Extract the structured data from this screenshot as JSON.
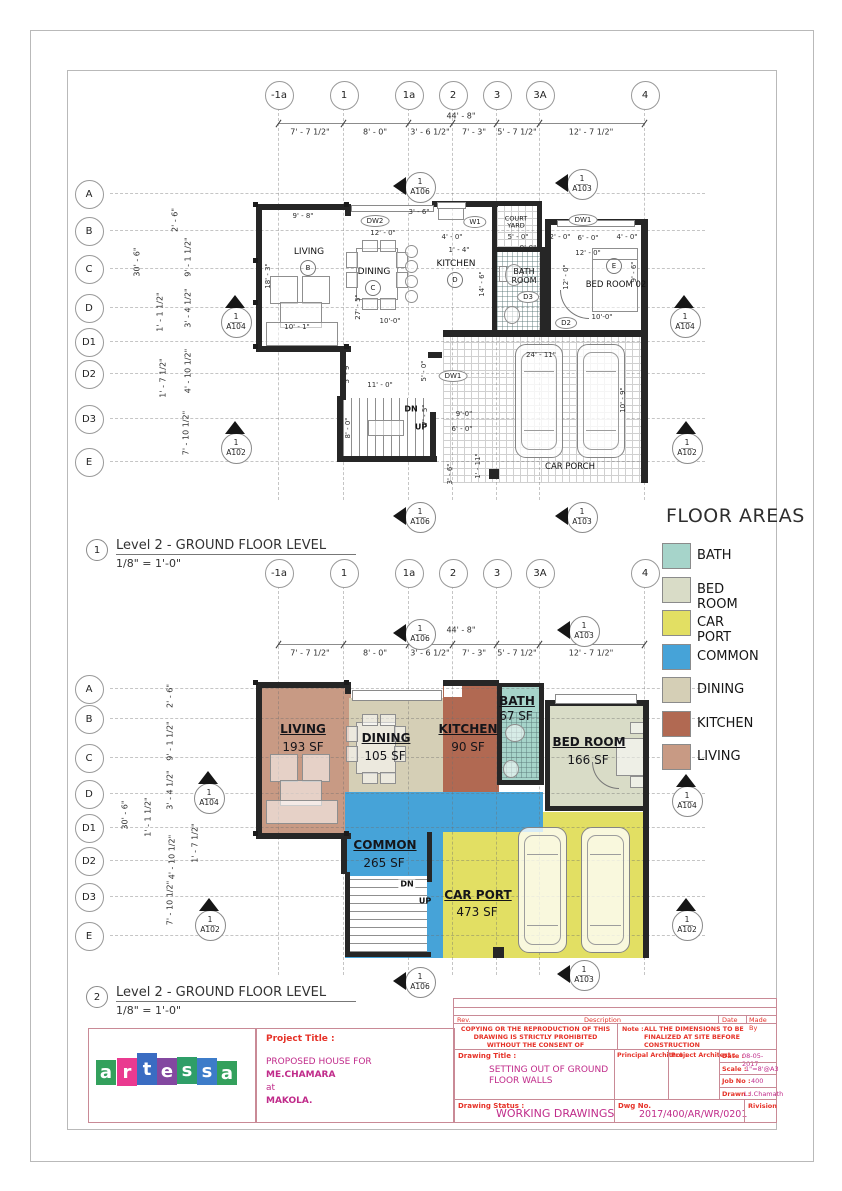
{
  "sheet": {
    "captions": {
      "plan1": {
        "number": "1",
        "title": "Level 2 - GROUND FLOOR LEVEL",
        "scale": "1/8\" = 1'-0\""
      },
      "plan2": {
        "number": "2",
        "title": "Level 2 - GROUND FLOOR LEVEL",
        "scale": "1/8\" = 1'-0\""
      }
    }
  },
  "grid": {
    "columns": [
      "-1a",
      "1",
      "1a",
      "2",
      "3",
      "3A",
      "4"
    ],
    "rows": [
      "A",
      "B",
      "C",
      "D",
      "D1",
      "D2",
      "D3",
      "E"
    ]
  },
  "dimensions": {
    "overall_width": "44' - 8\"",
    "overall_height": "30' - 6\"",
    "top_segments": [
      "7' - 7 1/2\"",
      "8' - 0\"",
      "3' - 6 1/2\"",
      "7' - 3\"",
      "5' - 7 1/2\"",
      "12' - 7 1/2\""
    ],
    "left_segments": [
      "2' - 6\"",
      "9' - 1 1/2\"",
      "3' - 4 1/2\"",
      "1' - 1 1/2\"",
      "1' - 7 1/2\"",
      "4' - 10 1/2\"",
      "7' - 10 1/2\""
    ]
  },
  "plan1": {
    "rooms": {
      "living": "LIVING",
      "living_tag": "B",
      "dining": "DINING",
      "dining_tag": "C",
      "kitchen": "KITCHEN",
      "kitchen_tag": "D",
      "bath": "BATH ROOM",
      "court": "COURT YARD",
      "bed": "BED ROOM 02",
      "bed_tag": "E",
      "carporch": "CAR PORCH"
    },
    "stair": {
      "down": "DN",
      "up": "UP"
    },
    "opening_tags": [
      "DW2",
      "W1",
      "DW1",
      "D3",
      "D2",
      "DW1"
    ],
    "dims": [
      "9' - 8\"",
      "12' - 0\"",
      "3' - 6\"",
      "4' - 0\"",
      "1' - 4\"",
      "5' - 0\"",
      "9'-0\"",
      "2' - 0\"",
      "6' - 0\"",
      "4' - 0\"",
      "12' - 0\"",
      "12' - 0\"",
      "9' - 6\"",
      "14' - 6\"",
      "18' - 3\"",
      "27' - 5\"",
      "10' - 1\"",
      "10'-0\"",
      "10'-0\"",
      "11' - 0\"",
      "5' - 9\"",
      "5' - 0\"",
      "8' - 0\"",
      "7' - 5\"",
      "9'-0\"",
      "6' - 0\"",
      "3' - 6\"",
      "1' - 11\"",
      "24' - 11\"",
      "10' - 9\""
    ]
  },
  "plan2": {
    "rooms": [
      {
        "key": "LIVING",
        "name": "LIVING",
        "area": "193 SF"
      },
      {
        "key": "DINING",
        "name": "DINING",
        "area": "105 SF"
      },
      {
        "key": "KITCHEN",
        "name": "KITCHEN",
        "area": "90 SF"
      },
      {
        "key": "BATH",
        "name": "BATH",
        "area": "67 SF"
      },
      {
        "key": "BED ROOM",
        "name": "BED ROOM",
        "area": "166 SF"
      },
      {
        "key": "COMMON",
        "name": "COMMON",
        "area": "265 SF"
      },
      {
        "key": "CAR PORT",
        "name": "CAR PORT",
        "area": "473 SF"
      }
    ],
    "stair": {
      "down": "DN",
      "up": "UP"
    }
  },
  "legend": {
    "title": "FLOOR AREAS",
    "items": [
      {
        "label": "BATH",
        "color": "#a6d4ca"
      },
      {
        "label": "BED ROOM",
        "color": "#d9dcc7"
      },
      {
        "label": "CAR PORT",
        "color": "#e2df63"
      },
      {
        "label": "COMMON",
        "color": "#46a3d8"
      },
      {
        "label": "DINING",
        "color": "#d5cfb6"
      },
      {
        "label": "KITCHEN",
        "color": "#b16952"
      },
      {
        "label": "LIVING",
        "color": "#c89a84"
      }
    ]
  },
  "section_markers": {
    "number": "1"
  },
  "title_block": {
    "logo_letters": [
      "a",
      "r",
      "t",
      "e",
      "s",
      "s",
      "a"
    ],
    "project_label": "Project Title :",
    "project_lines": [
      "PROPOSED HOUSE FOR",
      "ME.CHAMARA",
      "at",
      "MAKOLA."
    ],
    "rev": "Rev.",
    "description": "Description",
    "date_col": "Date",
    "made_by": "Made By",
    "copying": "COPYING OR THE REPRODUCTION OF THIS DRAWING IS STRICTLY PROHIBITED WITHOUT THE CONSENT OF",
    "note_label": "Note :",
    "note": "ALL THE DIMENSIONS TO BE FINALIZED AT SITE BEFORE CONSTRUCTION",
    "drawing_title_label": "Drawing Title :",
    "drawing_title": "SETTING OUT OF GROUND FLOOR WALLS",
    "principal_architect": "Principal Architect :",
    "project_architect": "Project Architect :",
    "date_label": "Date :",
    "date": "08-05-2017",
    "scale_label": "Scale :",
    "scale": "1\"=8'@A3",
    "job_label": "Job No :",
    "job": "400",
    "drawn_label": "Drawn :",
    "drawn": "L.I.Chamath",
    "status_label": "Drawing Status :",
    "status": "WORKING DRAWINGS",
    "dwg_label": "Dwg No.",
    "dwg": "2017/400/AR/WR/0201",
    "revision": "Rivision"
  }
}
